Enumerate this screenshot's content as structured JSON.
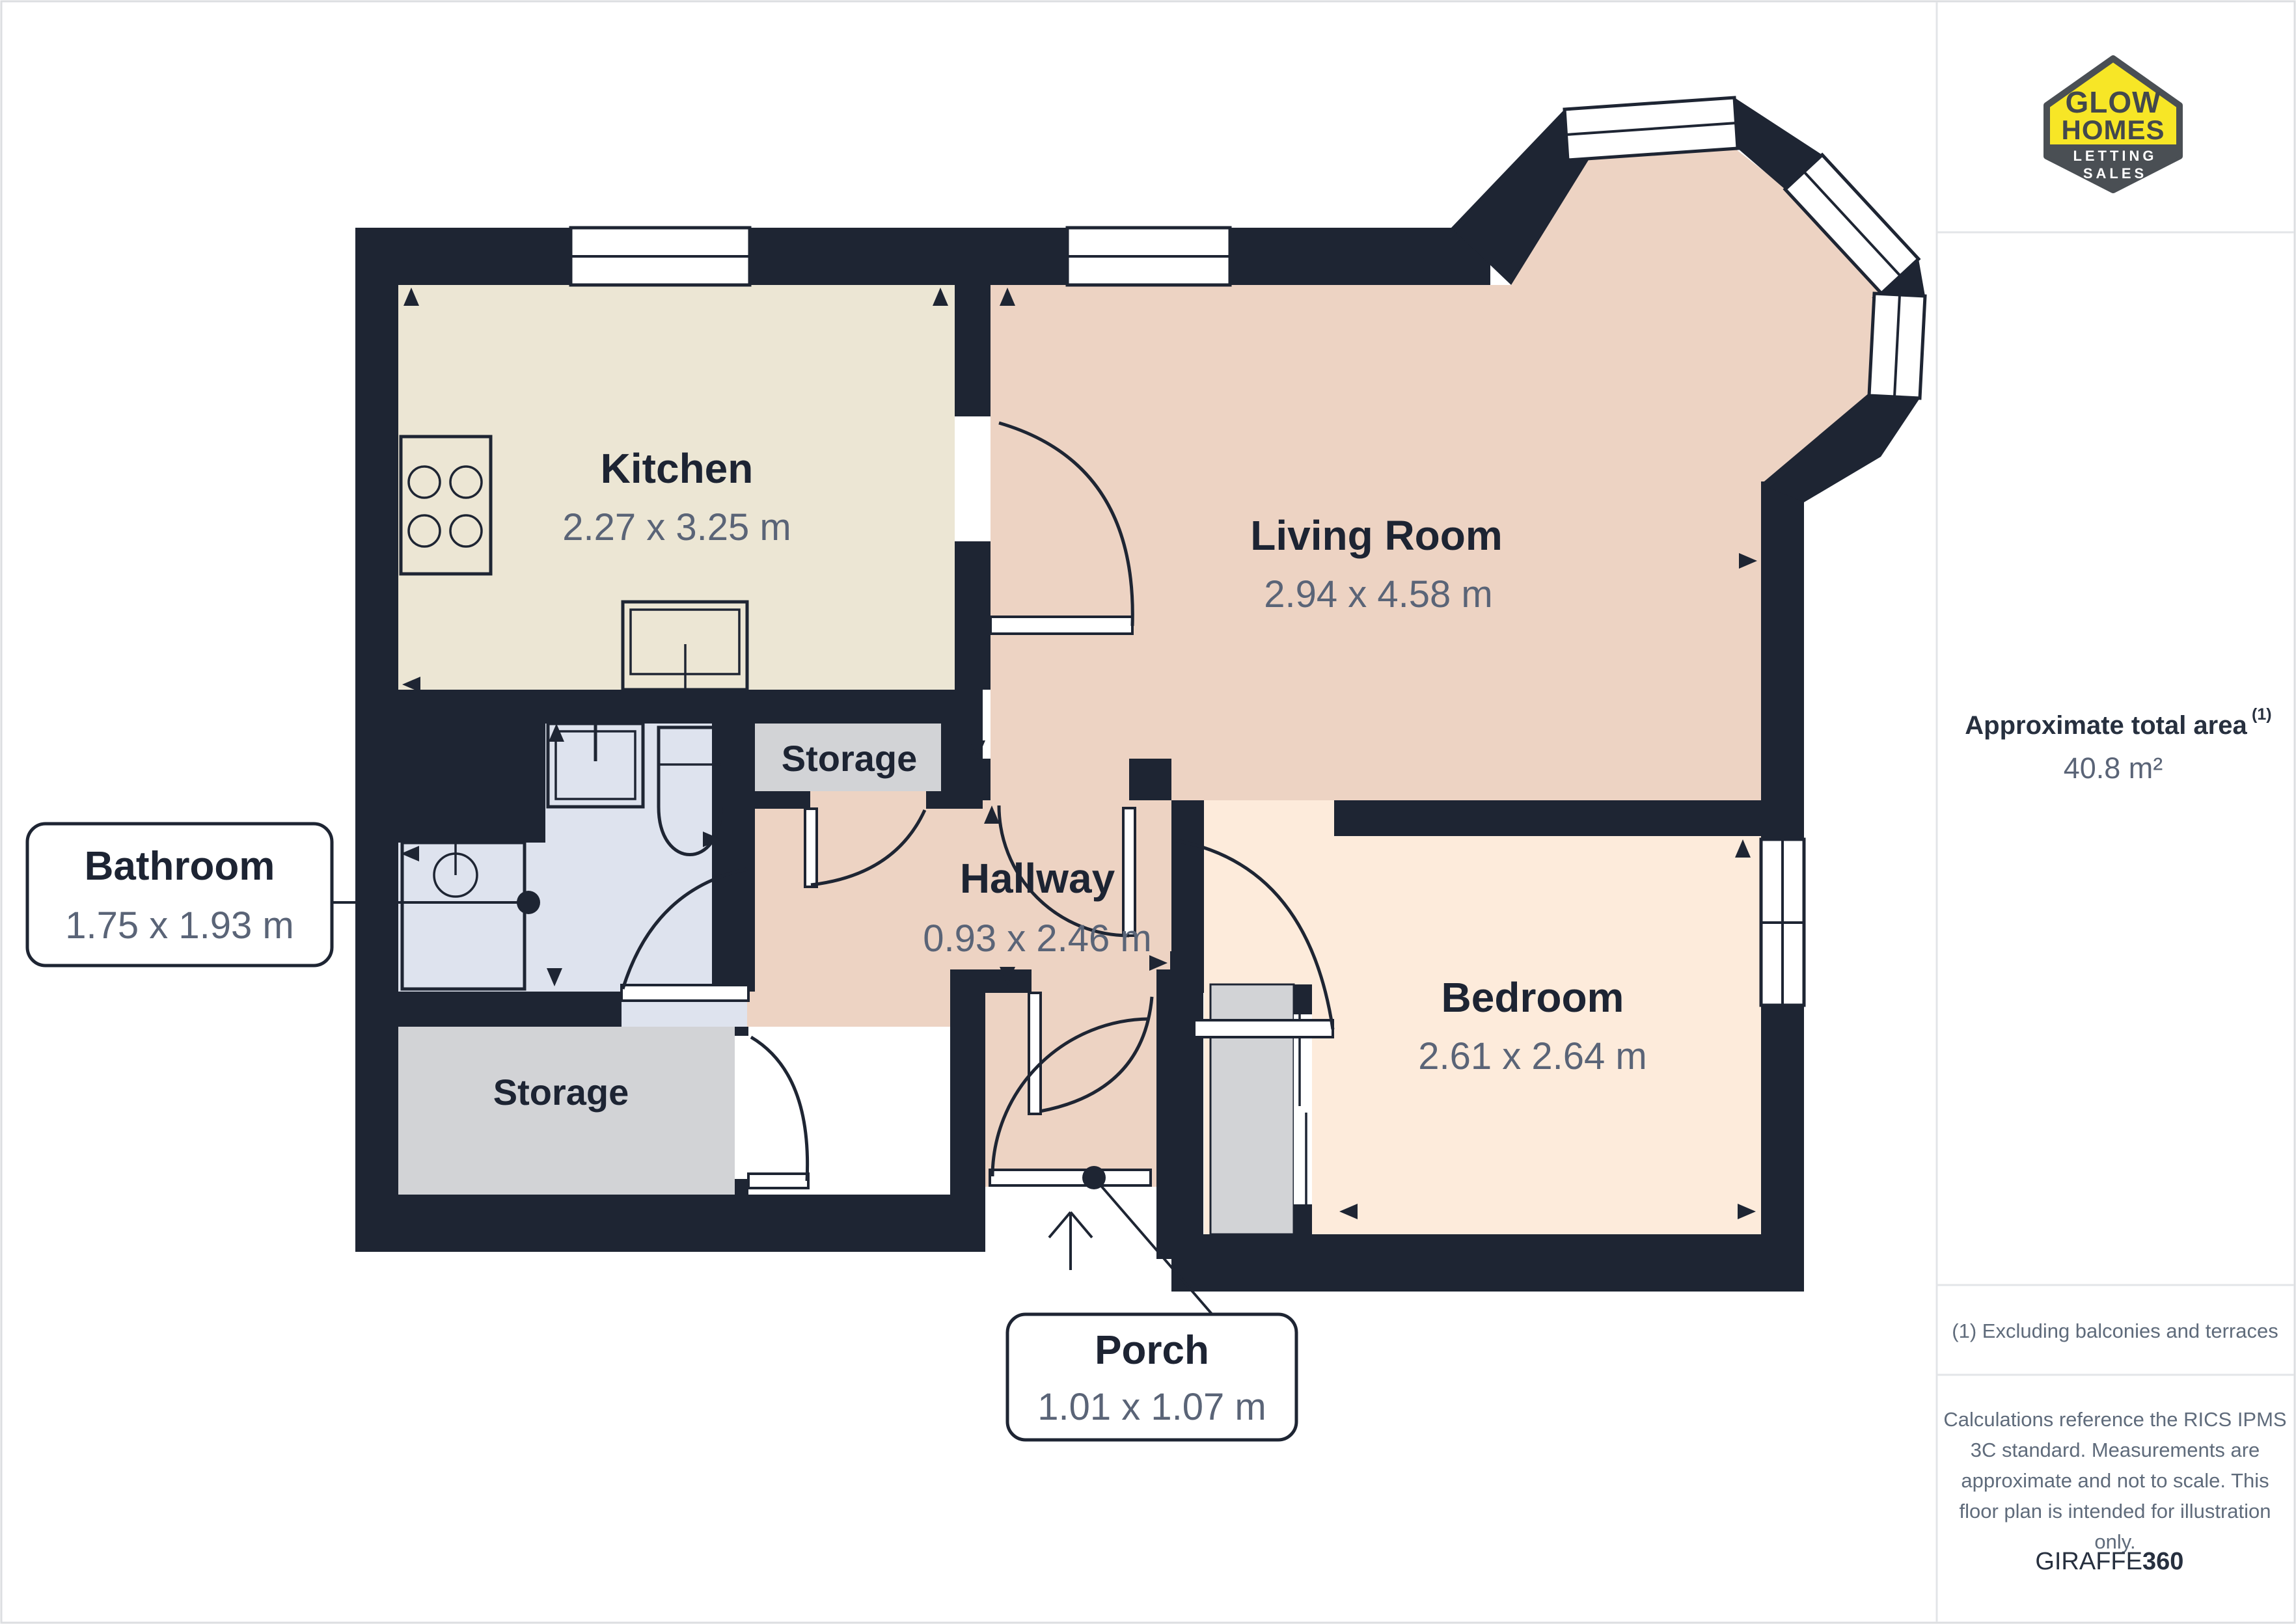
{
  "plan": {
    "rooms": {
      "kitchen": {
        "label": "Kitchen",
        "dims": "2.27 x 3.25 m"
      },
      "living": {
        "label": "Living Room",
        "dims": "2.94 x 4.58 m"
      },
      "hallway": {
        "label": "Hallway",
        "dims": "0.93 x 2.46 m"
      },
      "bedroom": {
        "label": "Bedroom",
        "dims": "2.61 x 2.64 m"
      }
    },
    "storage": {
      "upper": "Storage",
      "lower": "Storage"
    },
    "callouts": {
      "bathroom": {
        "label": "Bathroom",
        "dims": "1.75 x 1.93 m"
      },
      "porch": {
        "label": "Porch",
        "dims": "1.01 x 1.07 m"
      }
    }
  },
  "sidebar": {
    "logo": {
      "line1": "GLOW",
      "line2": "HOMES",
      "line3": "LETTING",
      "line4": "SALES"
    },
    "area_label": "Approximate total area",
    "area_sup": "(1)",
    "area_value": "40.8 m²",
    "footnote": "(1) Excluding balconies and terraces",
    "notes": [
      "Calculations reference the RICS IPMS",
      "3C standard. Measurements are",
      "approximate and not to scale. This",
      "floor plan is intended for illustration",
      "only."
    ],
    "brand": {
      "name": "GIRAFFE",
      "suffix": "360"
    }
  },
  "colors": {
    "wall": "#1e2533",
    "kitchen_floor": "#ece6d4",
    "living_floor": "#edd3c3",
    "bedroom_floor": "#fdebdb",
    "bathroom_floor": "#dee3ee",
    "storage_floor": "#d2d3d6",
    "label_text": "#1d2433",
    "dims_text": "#5a6477",
    "logo_yellow": "#f7e626",
    "logo_gray": "#4a4f54",
    "divider": "#e3e5e8"
  }
}
